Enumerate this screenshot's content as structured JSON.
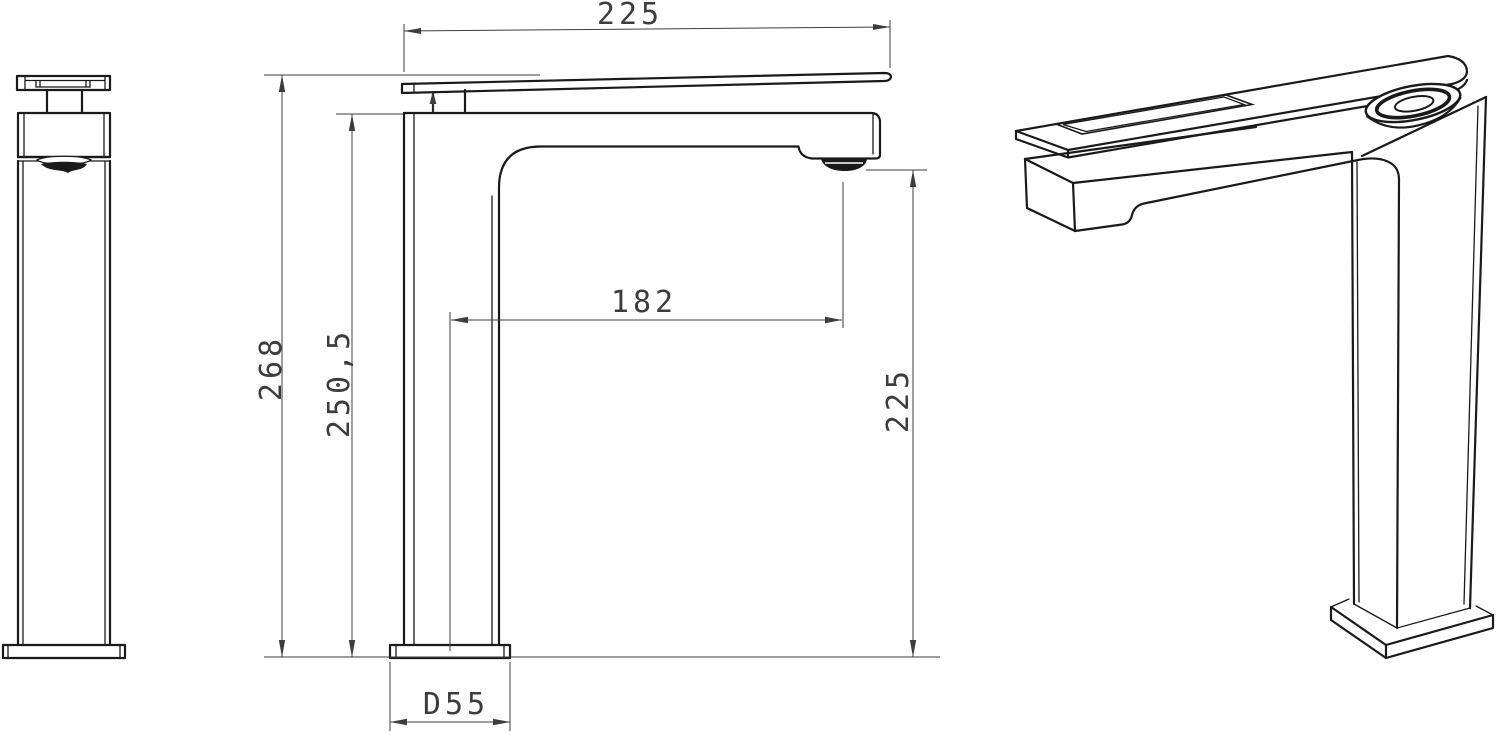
{
  "colors": {
    "background": "#ffffff",
    "line": "#1a1a1a",
    "dimension": "#3d3d3d"
  },
  "drawing": {
    "dimensions": {
      "spout_top_length": "225",
      "overall_height": "268",
      "spout_top_height": "250,5",
      "spout_reach": "182",
      "outlet_height": "225",
      "base_diameter": "D55"
    }
  }
}
